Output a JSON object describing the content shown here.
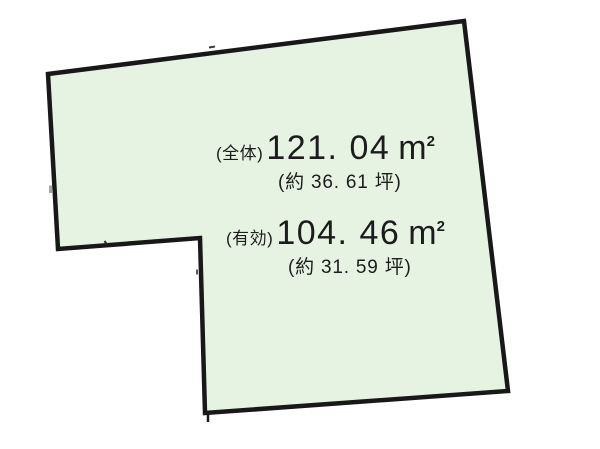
{
  "page": {
    "background_color": "#ffffff",
    "text_color": "#1c1c1c"
  },
  "plot": {
    "description": "land-parcel-outline",
    "fill_color": "#e6f3e2",
    "stroke_color": "#181818",
    "stroke_width": 4.5,
    "vertices": [
      [
        48,
        74
      ],
      [
        464,
        21
      ],
      [
        508,
        391
      ],
      [
        205,
        413
      ],
      [
        200,
        238
      ],
      [
        58,
        249
      ]
    ],
    "ticks": [
      {
        "x1": 209,
        "y1": 47.5,
        "x2": 215,
        "y2": 46.5,
        "w": 2,
        "color": "#3a3a3a"
      },
      {
        "x1": 50.5,
        "y1": 185.5,
        "x2": 50.5,
        "y2": 193,
        "w": 3,
        "color": "#a0a8a0"
      },
      {
        "x1": 104.5,
        "y1": 241,
        "x2": 107,
        "y2": 244.5,
        "w": 2,
        "color": "#2a2a2a"
      },
      {
        "x1": 197,
        "y1": 269.5,
        "x2": 197,
        "y2": 274.5,
        "w": 1.8,
        "color": "#4a4a4a"
      },
      {
        "x1": 208,
        "y1": 413,
        "x2": 208,
        "y2": 422,
        "w": 2.5,
        "color": "#181818"
      }
    ]
  },
  "measurements": {
    "total": {
      "label": "(全体)",
      "value": "121. 04",
      "unit": "m",
      "unit_exp": "2",
      "tsubo": "(約 36. 61 坪)"
    },
    "effective": {
      "label": "(有効)",
      "value": "104. 46",
      "unit": "m",
      "unit_exp": "2",
      "tsubo": "(約 31. 59 坪)"
    }
  }
}
